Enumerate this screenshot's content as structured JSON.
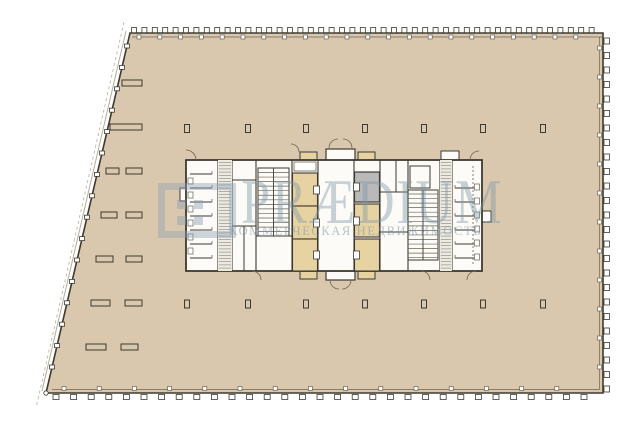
{
  "watermark": {
    "brand": "PRÆDIUM",
    "tagline": "КОММЕРЧЕСКАЯ НЕДВИЖИМОСТЬ",
    "logo_icon": "praedium-grid-logo"
  },
  "colors": {
    "background": "#ffffff",
    "floor": "#d9c8ad",
    "room": "#fcfbf7",
    "elevator_shaft": "#e7d2a2",
    "service_shaft": "#b9b9b9",
    "wall": "#3d3a31",
    "thin_line": "#6a6454",
    "hatch": "#8a8478",
    "edge_light": "#b5ac99",
    "watermark": "#8ca2b4"
  }
}
